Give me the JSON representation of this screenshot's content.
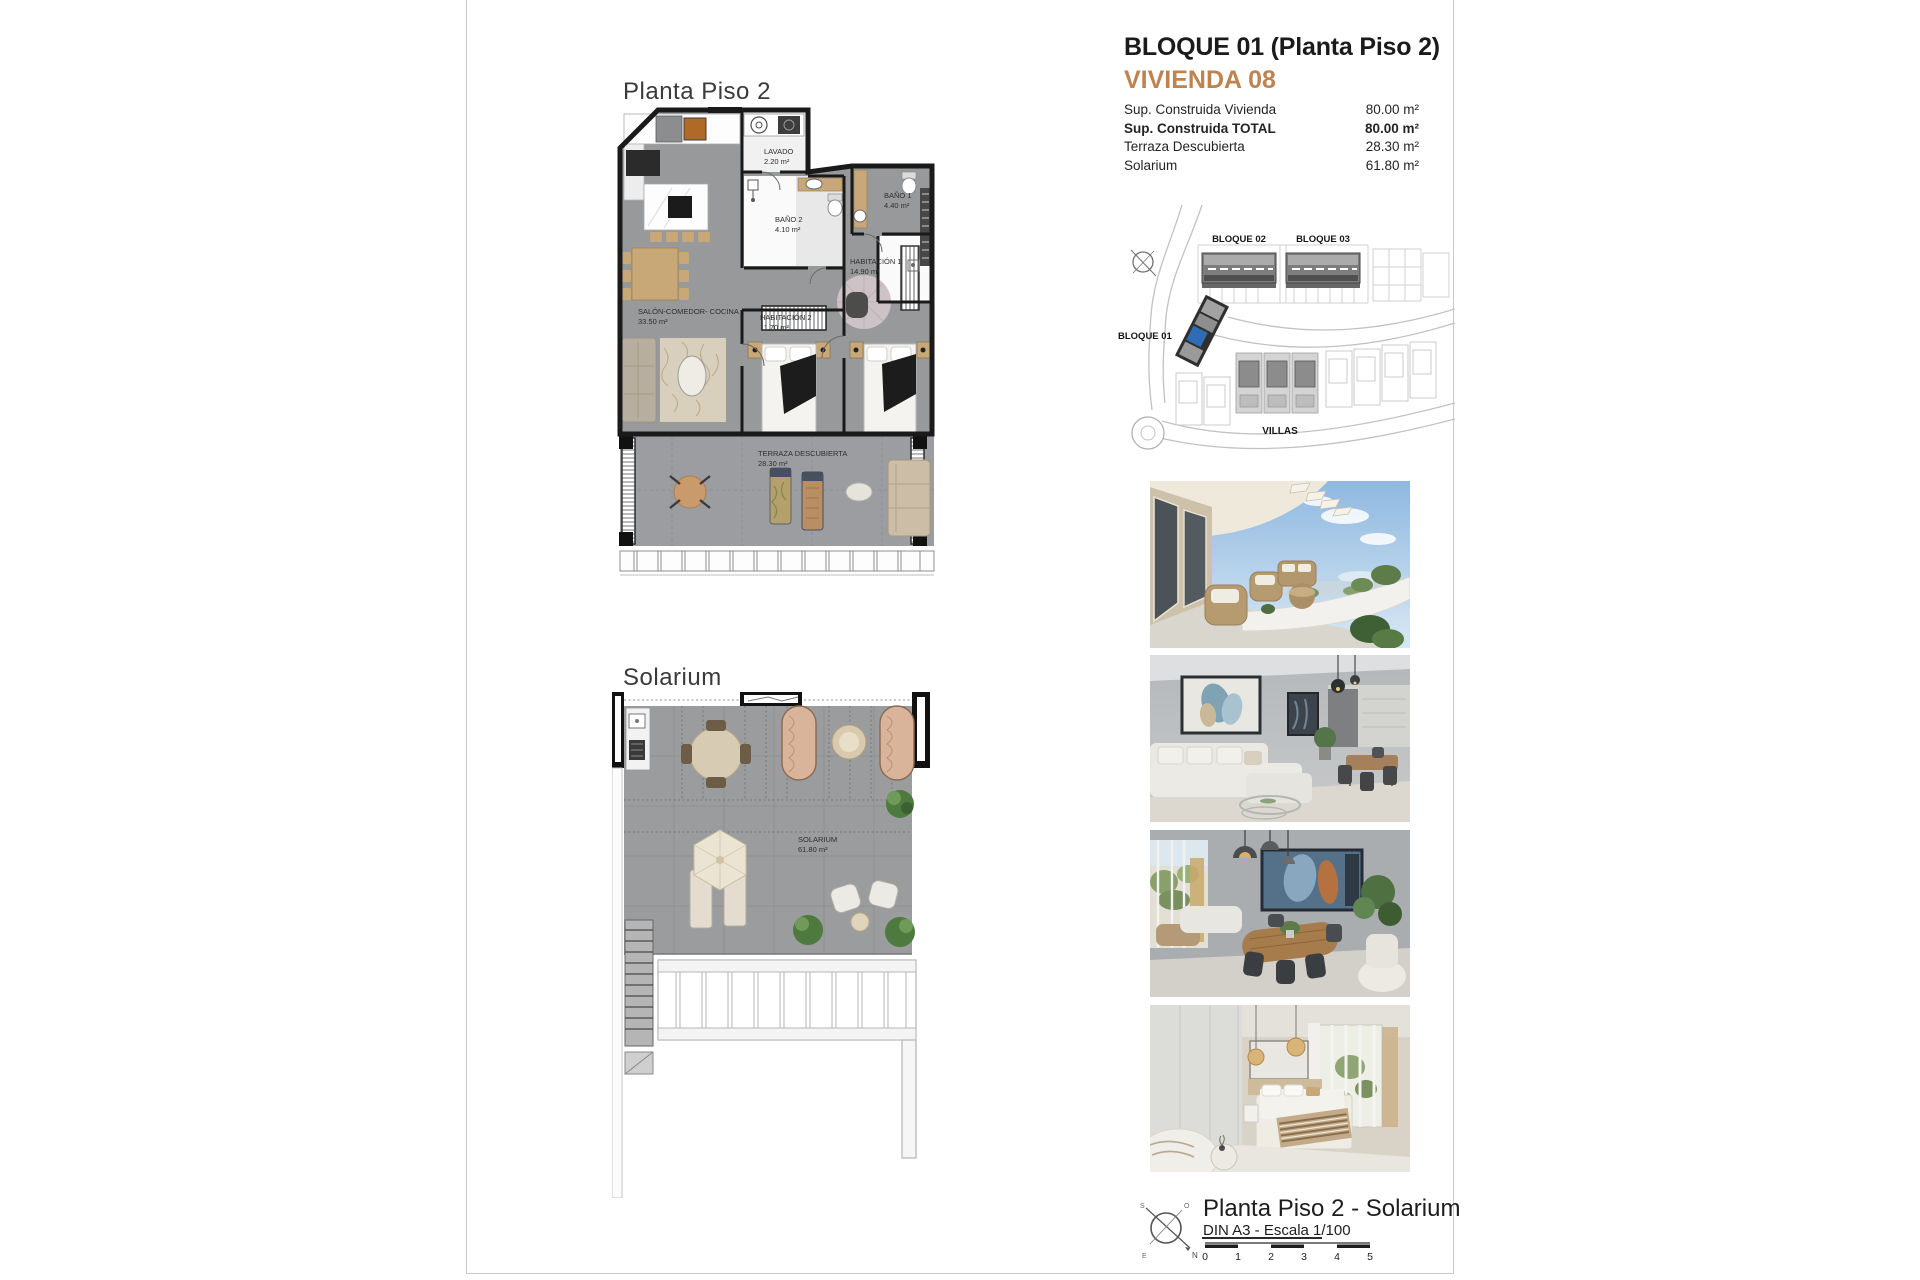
{
  "header": {
    "block_title": "BLOQUE 01  (Planta Piso 2)",
    "unit_title": "VIVIENDA 08",
    "accent_color": "#bf8350"
  },
  "specs": {
    "rows": [
      {
        "label": "Sup. Construida Vivienda",
        "value": "80.00 m²",
        "emphasis": false
      },
      {
        "label": "Sup. Construida TOTAL",
        "value": "80.00 m²",
        "emphasis": true
      },
      {
        "label": "Terraza Descubierta",
        "value": "28.30 m²",
        "emphasis": false
      },
      {
        "label": "Solarium",
        "value": "61.80 m²",
        "emphasis": false
      }
    ]
  },
  "site_plan": {
    "bloque01": "BLOQUE 01",
    "bloque02": "BLOQUE 02",
    "bloque03": "BLOQUE 03",
    "villas": "VILLAS",
    "highlight_color": "#2e6cb5"
  },
  "plans": {
    "plan1": {
      "title": "Planta Piso 2",
      "rooms": [
        {
          "name": "LAVADO",
          "area": "2.20 m²"
        },
        {
          "name": "BAÑO 2",
          "area": "4.10 m²"
        },
        {
          "name": "BAÑO 1",
          "area": "4.40 m²"
        },
        {
          "name": "HABITACIÓN 1",
          "area": "14.90 m²"
        },
        {
          "name": "HABITACIÓN 2",
          "area": "11.70 m²"
        },
        {
          "name": "SALÓN-COMEDOR- COCINA",
          "area": "33.50 m²"
        },
        {
          "name": "TERRAZA DESCUBIERTA",
          "area": "28.30 m²"
        }
      ],
      "wall_color": "#1a1a1a",
      "floor_color": "#97999b"
    },
    "plan2": {
      "title": "Solarium",
      "rooms": [
        {
          "name": "SOLARIUM",
          "area": "61.80 m²"
        }
      ]
    }
  },
  "photos": [
    {
      "name": "terrace-exterior-render"
    },
    {
      "name": "living-room-render"
    },
    {
      "name": "dining-room-render"
    },
    {
      "name": "bedroom-render"
    }
  ],
  "footer": {
    "title": "Planta Piso 2 - Solarium",
    "scale_note": "DIN A3 - Escala 1/100",
    "scale_ticks": [
      "0",
      "1",
      "2",
      "3",
      "4",
      "5"
    ],
    "compass": {
      "n": "N",
      "s": "S",
      "e": "E",
      "o": "O"
    }
  }
}
